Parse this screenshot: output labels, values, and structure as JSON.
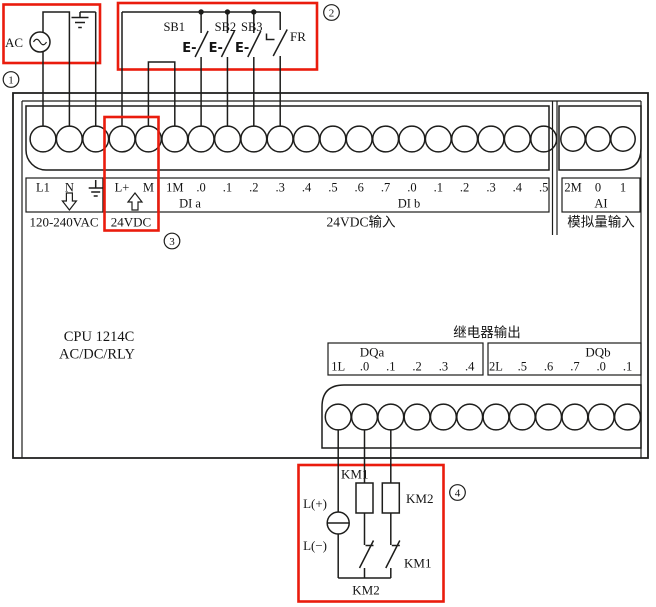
{
  "colors": {
    "highlight": "#ea1c0d",
    "line": "#1d1d1b"
  },
  "ac_circuit": {
    "label": "AC"
  },
  "button_circuit": {
    "sb1": "SB1",
    "sb2": "SB2",
    "sb3": "SB3",
    "fr": "FR",
    "pushbutton_symbol": "E-"
  },
  "terminals": {
    "power": [
      "L1",
      "N"
    ],
    "dc": [
      "L+",
      "M"
    ],
    "di": [
      "1M",
      ".0",
      ".1",
      ".2",
      ".3",
      ".4",
      ".5",
      ".6",
      ".7",
      ".0",
      ".1",
      ".2",
      ".3",
      ".4",
      ".5"
    ],
    "di_group_a": "DI a",
    "di_group_b": "DI b",
    "ai": [
      "2M",
      "0",
      "1"
    ],
    "ai_group": "AI"
  },
  "captions": {
    "power": "120-240VAC",
    "dc": "24VDC",
    "di_input": "24VDC输入",
    "ai_input": "模拟量输入"
  },
  "cpu": {
    "model": "CPU 1214C",
    "type": "AC/DC/RLY"
  },
  "output": {
    "title": "继电器输出",
    "group_a": "DQa",
    "group_b": "DQb",
    "dqa": [
      "1L",
      ".0",
      ".1",
      ".2",
      ".3",
      ".4"
    ],
    "dqb": [
      "2L",
      ".5",
      ".6",
      ".7",
      ".0",
      ".1"
    ]
  },
  "load_circuit": {
    "supply_positive": "L(+)",
    "supply_negative": "L(−)",
    "km1_coil": "KM1",
    "km2_coil": "KM2",
    "km1_contact": "KM1",
    "km2_contact": "KM2"
  },
  "callouts": {
    "c1": "1",
    "c2": "2",
    "c3": "3",
    "c4": "4"
  }
}
